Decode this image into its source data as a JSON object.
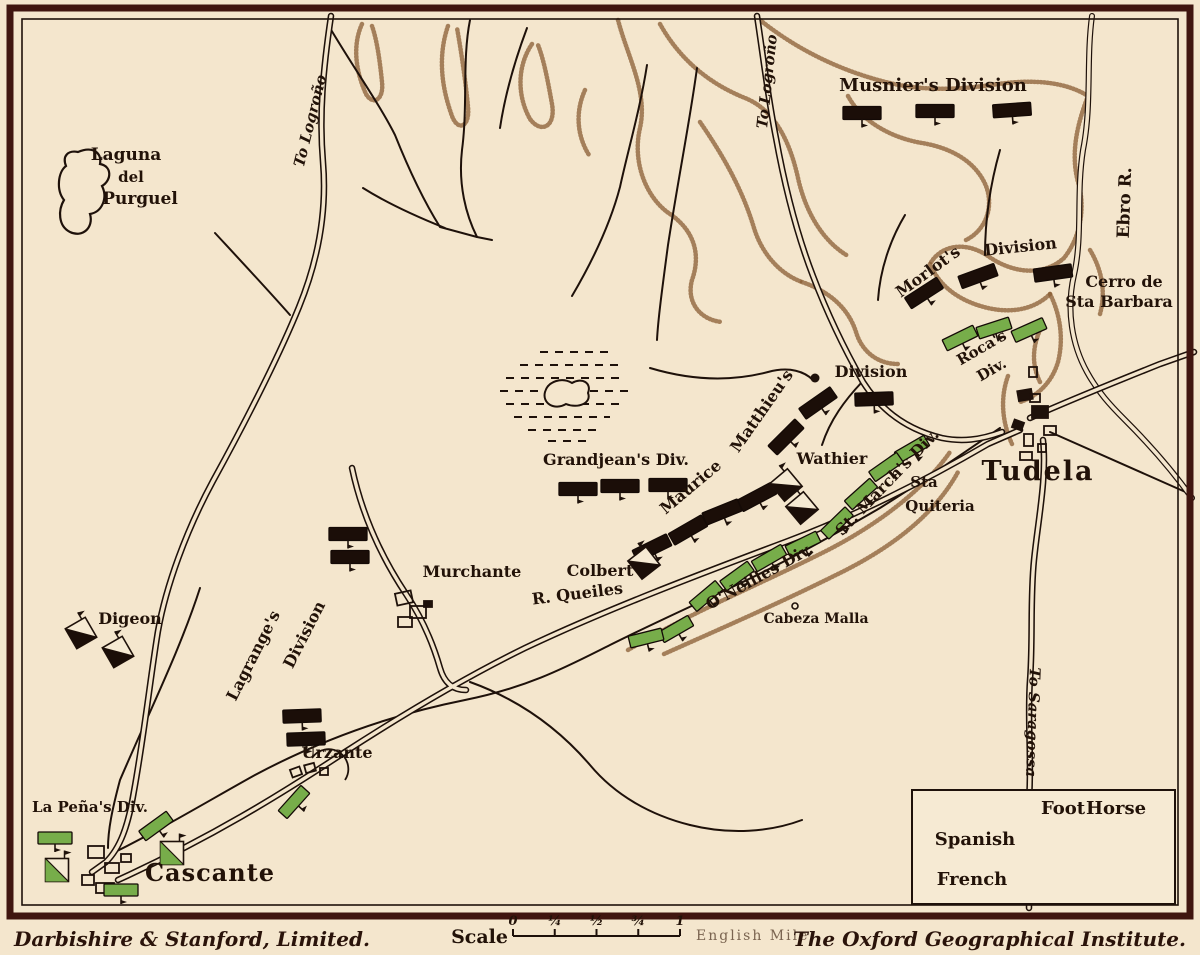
{
  "credits": {
    "left": "Darbishire & Stanford, Limited.",
    "right": "The Oxford Geographical Institute."
  },
  "scale_bar": {
    "label": "Scale",
    "ticks": [
      "0",
      "¼",
      "½",
      "¾",
      "1"
    ],
    "unit": "English Mile"
  },
  "legend": {
    "headers": [
      "Foot",
      "Horse"
    ],
    "rows": [
      {
        "name": "Spanish"
      },
      {
        "name": "French"
      }
    ]
  },
  "colors": {
    "paper": "#f4e6cd",
    "ink": "#1e110a",
    "spanish_green": "#77ad4a",
    "french_black": "#1b0e08",
    "hill_brown": "#8a5c33",
    "border_maroon": "#40150f"
  },
  "labels": [
    {
      "t": "Laguna",
      "x": 126,
      "y": 160,
      "s": 17
    },
    {
      "t": "del",
      "x": 131,
      "y": 182,
      "s": 15
    },
    {
      "t": "Purguel",
      "x": 140,
      "y": 204,
      "s": 17
    },
    {
      "t": "To Logroño",
      "x": 315,
      "y": 122,
      "r": -76,
      "s": 15,
      "i": 1
    },
    {
      "t": "To Logroño",
      "x": 772,
      "y": 82,
      "r": -84,
      "s": 15,
      "i": 1
    },
    {
      "t": "Musnier's Division",
      "x": 933,
      "y": 91,
      "s": 18
    },
    {
      "t": "Morlot's",
      "x": 931,
      "y": 276,
      "r": -36,
      "s": 16
    },
    {
      "t": "Division",
      "x": 1021,
      "y": 252,
      "r": -6,
      "s": 16
    },
    {
      "t": "Cerro de",
      "x": 1124,
      "y": 287,
      "s": 16
    },
    {
      "t": "Sta Barbara",
      "x": 1119,
      "y": 307,
      "s": 16
    },
    {
      "t": "Ebro R.",
      "x": 1130,
      "y": 203,
      "r": -88,
      "s": 17
    },
    {
      "t": "Roca's",
      "x": 984,
      "y": 352,
      "r": -30,
      "s": 15
    },
    {
      "t": "Div.",
      "x": 994,
      "y": 374,
      "r": -30,
      "s": 15
    },
    {
      "t": "Tudela",
      "x": 1038,
      "y": 480,
      "s": 27,
      "sp": 2
    },
    {
      "t": "Matthieu's",
      "x": 766,
      "y": 414,
      "r": -55,
      "s": 16
    },
    {
      "t": "Division",
      "x": 871,
      "y": 377,
      "s": 16
    },
    {
      "t": "Maurice",
      "x": 694,
      "y": 491,
      "r": -40,
      "s": 16
    },
    {
      "t": "Wathier",
      "x": 832,
      "y": 464,
      "s": 16
    },
    {
      "t": "Grandjean's Div.",
      "x": 616,
      "y": 465,
      "s": 16
    },
    {
      "t": "Colbert",
      "x": 600,
      "y": 576,
      "s": 16
    },
    {
      "t": "St. March's Div.",
      "x": 891,
      "y": 486,
      "r": -46,
      "s": 16
    },
    {
      "t": "Sta",
      "x": 924,
      "y": 487,
      "s": 15
    },
    {
      "t": "Quiteria",
      "x": 940,
      "y": 511,
      "s": 15
    },
    {
      "t": "O'Neilles Div.",
      "x": 762,
      "y": 581,
      "r": -29,
      "s": 16
    },
    {
      "t": "R. Queiles",
      "x": 578,
      "y": 599,
      "r": -7,
      "s": 16
    },
    {
      "t": "Cabeza Malla",
      "x": 816,
      "y": 623,
      "s": 14
    },
    {
      "t": "Murchante",
      "x": 472,
      "y": 577,
      "s": 16
    },
    {
      "t": "Lagrange's",
      "x": 258,
      "y": 658,
      "r": -63,
      "s": 16
    },
    {
      "t": "Division",
      "x": 309,
      "y": 637,
      "r": -63,
      "s": 16
    },
    {
      "t": "Digeon",
      "x": 130,
      "y": 624,
      "s": 16
    },
    {
      "t": "Urzante",
      "x": 337,
      "y": 758,
      "s": 16
    },
    {
      "t": "La Peña's Div.",
      "x": 90,
      "y": 812,
      "s": 15
    },
    {
      "t": "Cascante",
      "x": 210,
      "y": 881,
      "s": 24,
      "sp": 1
    },
    {
      "t": "To Saragossa",
      "x": 1028,
      "y": 722,
      "r": 92,
      "s": 15,
      "i": 1
    }
  ],
  "units": [
    {
      "side": "french",
      "type": "foot",
      "x": 862,
      "y": 113,
      "r": 0
    },
    {
      "side": "french",
      "type": "foot",
      "x": 935,
      "y": 111,
      "r": 0
    },
    {
      "side": "french",
      "type": "foot",
      "x": 1012,
      "y": 110,
      "r": -4
    },
    {
      "side": "french",
      "type": "foot",
      "x": 924,
      "y": 293,
      "r": -33
    },
    {
      "side": "french",
      "type": "foot",
      "x": 978,
      "y": 276,
      "r": -20
    },
    {
      "side": "french",
      "type": "foot",
      "x": 1053,
      "y": 273,
      "r": -8
    },
    {
      "side": "french",
      "type": "foot",
      "x": 818,
      "y": 403,
      "r": -35
    },
    {
      "side": "french",
      "type": "foot",
      "x": 874,
      "y": 399,
      "r": -2
    },
    {
      "side": "french",
      "type": "foot",
      "x": 786,
      "y": 437,
      "r": -45
    },
    {
      "side": "french",
      "type": "foot",
      "x": 757,
      "y": 497,
      "r": -28
    },
    {
      "side": "french",
      "type": "foot",
      "x": 722,
      "y": 512,
      "r": -22
    },
    {
      "side": "french",
      "type": "foot",
      "x": 688,
      "y": 530,
      "r": -30
    },
    {
      "side": "french",
      "type": "foot",
      "x": 652,
      "y": 548,
      "r": -26
    },
    {
      "side": "french",
      "type": "foot",
      "x": 578,
      "y": 489,
      "r": 0
    },
    {
      "side": "french",
      "type": "foot",
      "x": 620,
      "y": 486,
      "r": 0
    },
    {
      "side": "french",
      "type": "foot",
      "x": 668,
      "y": 485,
      "r": 0
    },
    {
      "side": "french",
      "type": "foot",
      "x": 348,
      "y": 534,
      "r": 0
    },
    {
      "side": "french",
      "type": "foot",
      "x": 350,
      "y": 557,
      "r": 0
    },
    {
      "side": "french",
      "type": "foot",
      "x": 302,
      "y": 716,
      "r": -2
    },
    {
      "side": "french",
      "type": "foot",
      "x": 306,
      "y": 739,
      "r": -2
    },
    {
      "side": "french",
      "type": "horse",
      "x": 786,
      "y": 485,
      "r": -40
    },
    {
      "side": "french",
      "type": "horse",
      "x": 802,
      "y": 508,
      "r": -40
    },
    {
      "side": "french",
      "type": "horse",
      "x": 644,
      "y": 563,
      "r": -38
    },
    {
      "side": "french",
      "type": "horse",
      "x": 81,
      "y": 633,
      "r": -30
    },
    {
      "side": "french",
      "type": "horse",
      "x": 118,
      "y": 652,
      "r": -30
    },
    {
      "side": "spanish",
      "type": "foot",
      "x": 960,
      "y": 338,
      "r": -26
    },
    {
      "side": "spanish",
      "type": "foot",
      "x": 994,
      "y": 328,
      "r": -18
    },
    {
      "side": "spanish",
      "type": "foot",
      "x": 1029,
      "y": 330,
      "r": -24
    },
    {
      "side": "spanish",
      "type": "foot",
      "x": 912,
      "y": 449,
      "r": -30
    },
    {
      "side": "spanish",
      "type": "foot",
      "x": 886,
      "y": 467,
      "r": -35
    },
    {
      "side": "spanish",
      "type": "foot",
      "x": 861,
      "y": 494,
      "r": -42
    },
    {
      "side": "spanish",
      "type": "foot",
      "x": 837,
      "y": 523,
      "r": -44
    },
    {
      "side": "spanish",
      "type": "foot",
      "x": 803,
      "y": 544,
      "r": -26
    },
    {
      "side": "spanish",
      "type": "foot",
      "x": 769,
      "y": 558,
      "r": -30
    },
    {
      "side": "spanish",
      "type": "foot",
      "x": 737,
      "y": 576,
      "r": -36
    },
    {
      "side": "spanish",
      "type": "foot",
      "x": 706,
      "y": 596,
      "r": -40
    },
    {
      "side": "spanish",
      "type": "foot",
      "x": 676,
      "y": 629,
      "r": -30
    },
    {
      "side": "spanish",
      "type": "foot",
      "x": 646,
      "y": 638,
      "r": -14
    },
    {
      "side": "spanish",
      "type": "foot",
      "x": 55,
      "y": 838,
      "r": 0
    },
    {
      "side": "spanish",
      "type": "foot",
      "x": 156,
      "y": 826,
      "r": -36
    },
    {
      "side": "spanish",
      "type": "foot",
      "x": 121,
      "y": 890,
      "r": 0
    },
    {
      "side": "spanish",
      "type": "foot",
      "x": 294,
      "y": 802,
      "r": -48
    },
    {
      "side": "spanish",
      "type": "horse",
      "x": 57,
      "y": 870,
      "r": 0
    },
    {
      "side": "spanish",
      "type": "horse",
      "x": 172,
      "y": 853,
      "r": 0
    },
    {
      "side": "spanish",
      "type": "foot",
      "x": 1067,
      "y": 838,
      "r": 0,
      "w": 22,
      "h": 22,
      "pole": "up",
      "legend": true
    },
    {
      "side": "spanish",
      "type": "horse",
      "x": 1110,
      "y": 838,
      "r": 0,
      "legend": true
    },
    {
      "side": "french",
      "type": "foot",
      "x": 1070,
      "y": 877,
      "r": 0,
      "w": 22,
      "h": 22,
      "pole": "up",
      "legend": true
    },
    {
      "side": "french",
      "type": "horse",
      "x": 1108,
      "y": 876,
      "r": 0,
      "legend": true
    }
  ]
}
